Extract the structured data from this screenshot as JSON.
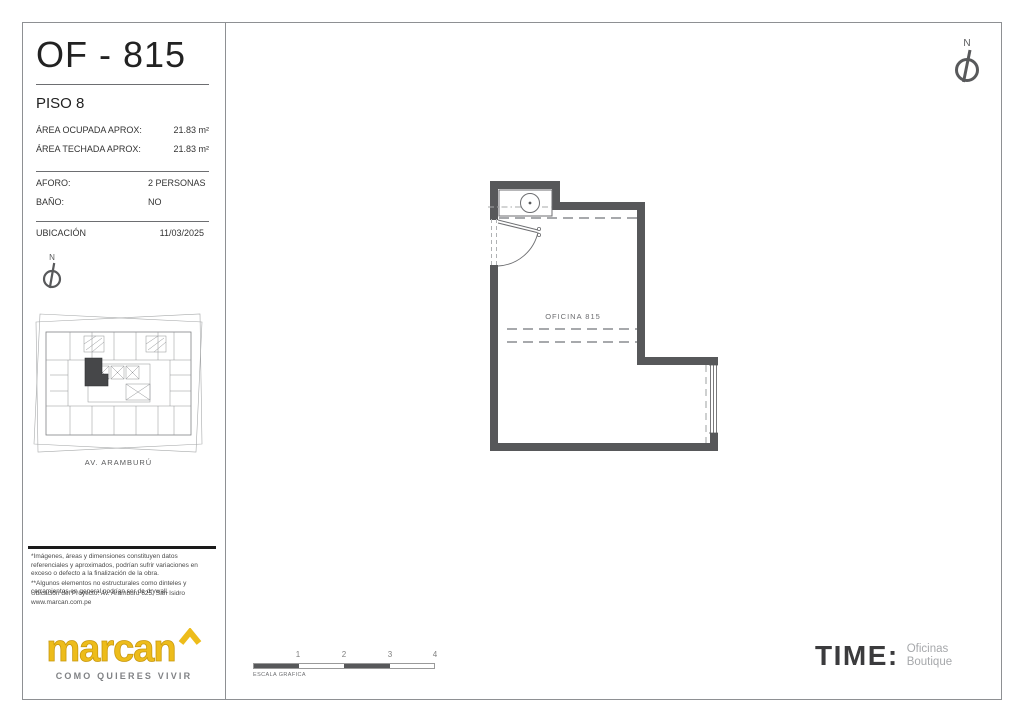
{
  "sheet": {
    "unit_title": "OF - 815",
    "floor": "PISO 8",
    "areas": [
      {
        "label": "ÁREA OCUPADA APROX:",
        "value": "21.83 m²"
      },
      {
        "label": "ÁREA TECHADA APROX:",
        "value": "21.83 m²"
      }
    ],
    "details": [
      {
        "label": "AFORO:",
        "value": "2 PERSONAS"
      },
      {
        "label": "BAÑO:",
        "value": "NO"
      }
    ],
    "location_label": "UBICACIÓN",
    "location_date": "11/03/2025",
    "north_letter": "N",
    "keyplan_street": "AV. ARAMBURÚ",
    "disclaimer_line1": "*Imágenes, áreas y dimensiones constituyen datos referenciales y aproximados, podrían sufrir variaciones en exceso o defecto a la finalización de la obra.",
    "disclaimer_line2": "**Algunos elementos no estructurales como dinteles y cerramientos en general podrían ser de drywall.",
    "project_address": "Ubicación del Proyecto: Av. Aramburú 625, San Isidro",
    "website": "www.marcan.com.pe"
  },
  "plan": {
    "room_label": "OFICINA 815"
  },
  "scale_bar": {
    "label": "ESCALA GRAFICA",
    "ticks": [
      "1",
      "2",
      "3",
      "4"
    ]
  },
  "branding": {
    "marcan_name": "marcan",
    "marcan_tagline": "COMO QUIERES VIVIR",
    "marcan_color": "#EDBC1A",
    "time_name": "TIME:",
    "time_sub_line1": "Oficinas",
    "time_sub_line2": "Boutique"
  },
  "colors": {
    "wall": "#57585A",
    "thin_line": "#6D6E71",
    "dashed_line": "#A7A9AA",
    "frame": "#8E9093"
  }
}
